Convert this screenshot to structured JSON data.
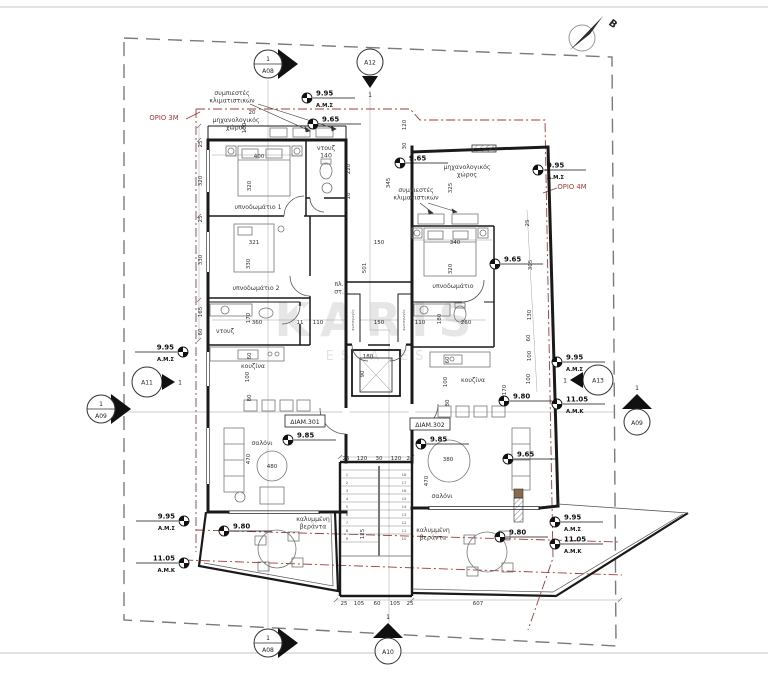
{
  "drawing": {
    "north_label": "Β",
    "watermark": {
      "line1": "KARIS",
      "line2": "ESTATES"
    },
    "colors": {
      "wall": "#1a1a1a",
      "boundary_red": "#a03a38",
      "property_dash": "#7a7a7a",
      "watermark": "#d6d6d6"
    },
    "orio_labels": [
      {
        "text": "ΟΡΙΟ 3Μ",
        "x": 164,
        "y": 120
      },
      {
        "text": "ΟΡΙΟ 4Μ",
        "x": 572,
        "y": 189
      }
    ],
    "unit_labels": [
      {
        "text": "ΔΙΑΜ.301",
        "x": 305,
        "y": 424
      },
      {
        "text": "ΔΙΑΜ.302",
        "x": 430,
        "y": 427
      }
    ],
    "section_markers": [
      {
        "label": "A08",
        "num": "1",
        "x": 268,
        "y": 64,
        "type": "section-right"
      },
      {
        "label": "A12",
        "num": "1",
        "x": 370,
        "y": 62,
        "type": "below-arrow"
      },
      {
        "label": "A11",
        "num": "1",
        "x": 147,
        "y": 382,
        "type": "right-arrow"
      },
      {
        "label": "A13",
        "num": "1",
        "x": 598,
        "y": 380,
        "type": "left-arrow"
      },
      {
        "label": "A09",
        "num": "1",
        "x": 101,
        "y": 409,
        "type": "section-right"
      },
      {
        "label": "A09",
        "num": "1",
        "x": 637,
        "y": 421,
        "type": "above-arrow"
      },
      {
        "label": "A08",
        "num": "1",
        "x": 268,
        "y": 643,
        "type": "section-right"
      },
      {
        "label": "A10",
        "num": "1",
        "x": 388,
        "y": 650,
        "type": "above-arrow"
      }
    ],
    "benchmarks": [
      {
        "v": "9.95",
        "s": "Α.Μ.Σ",
        "x": 307,
        "y": 98,
        "side": "right"
      },
      {
        "v": "9.65",
        "x": 313,
        "y": 124,
        "side": "right"
      },
      {
        "v": "9.65",
        "x": 400,
        "y": 163,
        "side": "right"
      },
      {
        "v": "9.95",
        "s": "Α.Μ.Σ",
        "x": 538,
        "y": 170,
        "side": "right"
      },
      {
        "v": "9.65",
        "x": 495,
        "y": 264,
        "side": "right"
      },
      {
        "v": "9.95",
        "s": "Α.Μ.Σ",
        "x": 183,
        "y": 352,
        "side": "left"
      },
      {
        "v": "9.85",
        "x": 288,
        "y": 440,
        "side": "right"
      },
      {
        "v": "9.85",
        "x": 421,
        "y": 444,
        "side": "right"
      },
      {
        "v": "9.80",
        "x": 504,
        "y": 401,
        "side": "right"
      },
      {
        "v": "9.65",
        "x": 508,
        "y": 459,
        "side": "right"
      },
      {
        "v": "9.80",
        "x": 224,
        "y": 531,
        "side": "right"
      },
      {
        "v": "9.80",
        "x": 500,
        "y": 537,
        "side": "right"
      },
      {
        "v": "9.95",
        "s": "Α.Μ.Σ",
        "x": 184,
        "y": 521,
        "side": "left"
      },
      {
        "v": "11.05",
        "s": "Α.Μ.Κ",
        "x": 184,
        "y": 563,
        "side": "left"
      },
      {
        "v": "9.95",
        "s": "Α.Μ.Σ",
        "x": 557,
        "y": 362,
        "side": "right"
      },
      {
        "v": "11.05",
        "s": "Α.Μ.Κ",
        "x": 557,
        "y": 404,
        "side": "right"
      },
      {
        "v": "9.95",
        "s": "Α.Μ.Σ",
        "x": 555,
        "y": 522,
        "side": "right"
      },
      {
        "v": "11.05",
        "s": "Α.Μ.Κ",
        "x": 555,
        "y": 544,
        "side": "right"
      }
    ],
    "room_labels": [
      {
        "lines": [
          "υπνοδωμάτιο 1"
        ],
        "x": 258,
        "y": 209
      },
      {
        "lines": [
          "υπνοδωμάτιο 2"
        ],
        "x": 256,
        "y": 290
      },
      {
        "lines": [
          "υπνοδωμάτιο"
        ],
        "x": 453,
        "y": 288
      },
      {
        "lines": [
          "σαλόνι"
        ],
        "x": 262,
        "y": 445
      },
      {
        "lines": [
          "σαλόνι"
        ],
        "x": 442,
        "y": 498
      },
      {
        "lines": [
          "κουζίνα"
        ],
        "x": 253,
        "y": 368
      },
      {
        "lines": [
          "κουζίνα"
        ],
        "x": 473,
        "y": 382
      },
      {
        "lines": [
          "ντουζ",
          "140"
        ],
        "x": 326,
        "y": 150
      },
      {
        "lines": [
          "ντουζ"
        ],
        "x": 225,
        "y": 333
      },
      {
        "lines": [
          "μηχανολογικός",
          "χώρος"
        ],
        "x": 236,
        "y": 122
      },
      {
        "lines": [
          "μηχανολογικός",
          "χώρος"
        ],
        "x": 467,
        "y": 169
      },
      {
        "lines": [
          "συμπιεστές",
          "κλιματιστικών"
        ],
        "x": 232,
        "y": 95
      },
      {
        "lines": [
          "συμπιεστές",
          "κλιματιστικών"
        ],
        "x": 416,
        "y": 192
      },
      {
        "lines": [
          "καλυμμένη",
          "βεράντα"
        ],
        "x": 313,
        "y": 521
      },
      {
        "lines": [
          "καλυμμένη",
          "βεράντα"
        ],
        "x": 433,
        "y": 532
      },
      {
        "lines": [
          "πλ.",
          "στ."
        ],
        "x": 339,
        "y": 286
      },
      {
        "lines": [
          "φωταγωγός"
        ],
        "x": 354,
        "y": 320,
        "r": 1,
        "s": 1
      },
      {
        "lines": [
          "φωταγωγός"
        ],
        "x": 405,
        "y": 320,
        "r": 1,
        "s": 1
      }
    ],
    "dims": [
      {
        "t": "25",
        "x": 202,
        "y": 144,
        "r": 1
      },
      {
        "t": "320",
        "x": 202,
        "y": 181,
        "r": 1
      },
      {
        "t": "25",
        "x": 202,
        "y": 219,
        "r": 1
      },
      {
        "t": "330",
        "x": 202,
        "y": 260,
        "r": 1
      },
      {
        "t": "165",
        "x": 202,
        "y": 312,
        "r": 1
      },
      {
        "t": "60",
        "x": 202,
        "y": 332,
        "r": 1
      },
      {
        "t": "400",
        "x": 259,
        "y": 158
      },
      {
        "t": "320",
        "x": 251,
        "y": 186,
        "r": 1
      },
      {
        "t": "321",
        "x": 254,
        "y": 244
      },
      {
        "t": "330",
        "x": 250,
        "y": 264,
        "r": 1
      },
      {
        "t": "340",
        "x": 455,
        "y": 244
      },
      {
        "t": "320",
        "x": 452,
        "y": 269,
        "r": 1
      },
      {
        "t": "220",
        "x": 350,
        "y": 169,
        "r": 1
      },
      {
        "t": "10",
        "x": 350,
        "y": 196,
        "r": 1
      },
      {
        "t": "345",
        "x": 390,
        "y": 183,
        "r": 1
      },
      {
        "t": "20",
        "x": 252,
        "y": 114
      },
      {
        "t": "100",
        "x": 246,
        "y": 128,
        "r": 1
      },
      {
        "t": "120",
        "x": 406,
        "y": 125,
        "r": 1
      },
      {
        "t": "30",
        "x": 406,
        "y": 146,
        "r": 1
      },
      {
        "t": "325",
        "x": 452,
        "y": 188,
        "r": 1
      },
      {
        "t": "501",
        "x": 366,
        "y": 268,
        "r": 1
      },
      {
        "t": "150",
        "x": 379,
        "y": 244
      },
      {
        "t": "360",
        "x": 257,
        "y": 324
      },
      {
        "t": "11",
        "x": 300,
        "y": 324
      },
      {
        "t": "110",
        "x": 318,
        "y": 324
      },
      {
        "t": "150",
        "x": 379,
        "y": 324
      },
      {
        "t": "110",
        "x": 420,
        "y": 324
      },
      {
        "t": "260",
        "x": 466,
        "y": 324
      },
      {
        "t": "170",
        "x": 250,
        "y": 318,
        "r": 1
      },
      {
        "t": "180",
        "x": 441,
        "y": 319,
        "r": 1
      },
      {
        "t": "60",
        "x": 251,
        "y": 356,
        "r": 1
      },
      {
        "t": "100",
        "x": 249,
        "y": 377,
        "r": 1
      },
      {
        "t": "80",
        "x": 251,
        "y": 398,
        "r": 1
      },
      {
        "t": "60",
        "x": 449,
        "y": 360,
        "r": 1
      },
      {
        "t": "100",
        "x": 447,
        "y": 382,
        "r": 1
      },
      {
        "t": "80",
        "x": 449,
        "y": 403,
        "r": 1
      },
      {
        "t": "470",
        "x": 250,
        "y": 459,
        "r": 1
      },
      {
        "t": "480",
        "x": 272,
        "y": 468
      },
      {
        "t": "380",
        "x": 448,
        "y": 461
      },
      {
        "t": "470",
        "x": 428,
        "y": 481,
        "r": 1
      },
      {
        "t": "25",
        "x": 529,
        "y": 223,
        "r": 1
      },
      {
        "t": "305",
        "x": 532,
        "y": 265,
        "r": 1
      },
      {
        "t": "130",
        "x": 531,
        "y": 315,
        "r": 1
      },
      {
        "t": "60",
        "x": 530,
        "y": 338,
        "r": 1
      },
      {
        "t": "100",
        "x": 531,
        "y": 356,
        "r": 1
      },
      {
        "t": "100",
        "x": 530,
        "y": 379,
        "r": 1
      },
      {
        "t": "170",
        "x": 506,
        "y": 390,
        "r": 1
      },
      {
        "t": "180",
        "x": 368,
        "y": 358
      },
      {
        "t": "90",
        "x": 364,
        "y": 374,
        "r": 1
      },
      {
        "t": "25",
        "x": 346,
        "y": 460
      },
      {
        "t": "120",
        "x": 362,
        "y": 460
      },
      {
        "t": "30",
        "x": 379,
        "y": 460
      },
      {
        "t": "120",
        "x": 396,
        "y": 460
      },
      {
        "t": "25",
        "x": 410,
        "y": 460
      },
      {
        "t": "125",
        "x": 364,
        "y": 534,
        "r": 1
      },
      {
        "t": "25",
        "x": 344,
        "y": 605
      },
      {
        "t": "105",
        "x": 359,
        "y": 605
      },
      {
        "t": "60",
        "x": 377,
        "y": 605
      },
      {
        "t": "105",
        "x": 395,
        "y": 605
      },
      {
        "t": "25",
        "x": 410,
        "y": 605
      },
      {
        "t": "607",
        "x": 478,
        "y": 605
      },
      {
        "t": "1",
        "x": 347,
        "y": 476,
        "s": 1
      },
      {
        "t": "2",
        "x": 347,
        "y": 484,
        "s": 1
      },
      {
        "t": "3",
        "x": 347,
        "y": 492,
        "s": 1
      },
      {
        "t": "4",
        "x": 347,
        "y": 500,
        "s": 1
      },
      {
        "t": "5",
        "x": 347,
        "y": 508,
        "s": 1
      },
      {
        "t": "6",
        "x": 347,
        "y": 516,
        "s": 1
      },
      {
        "t": "7",
        "x": 347,
        "y": 524,
        "s": 1
      },
      {
        "t": "8",
        "x": 347,
        "y": 532,
        "s": 1
      },
      {
        "t": "9",
        "x": 347,
        "y": 540,
        "s": 1
      },
      {
        "t": "18",
        "x": 404,
        "y": 476,
        "s": 1
      },
      {
        "t": "17",
        "x": 404,
        "y": 484,
        "s": 1
      },
      {
        "t": "16",
        "x": 404,
        "y": 492,
        "s": 1
      },
      {
        "t": "15",
        "x": 404,
        "y": 500,
        "s": 1
      },
      {
        "t": "14",
        "x": 404,
        "y": 508,
        "s": 1
      },
      {
        "t": "13",
        "x": 404,
        "y": 516,
        "s": 1
      },
      {
        "t": "12",
        "x": 404,
        "y": 524,
        "s": 1
      },
      {
        "t": "11",
        "x": 404,
        "y": 532,
        "s": 1
      },
      {
        "t": "10",
        "x": 404,
        "y": 540,
        "s": 1
      }
    ]
  }
}
